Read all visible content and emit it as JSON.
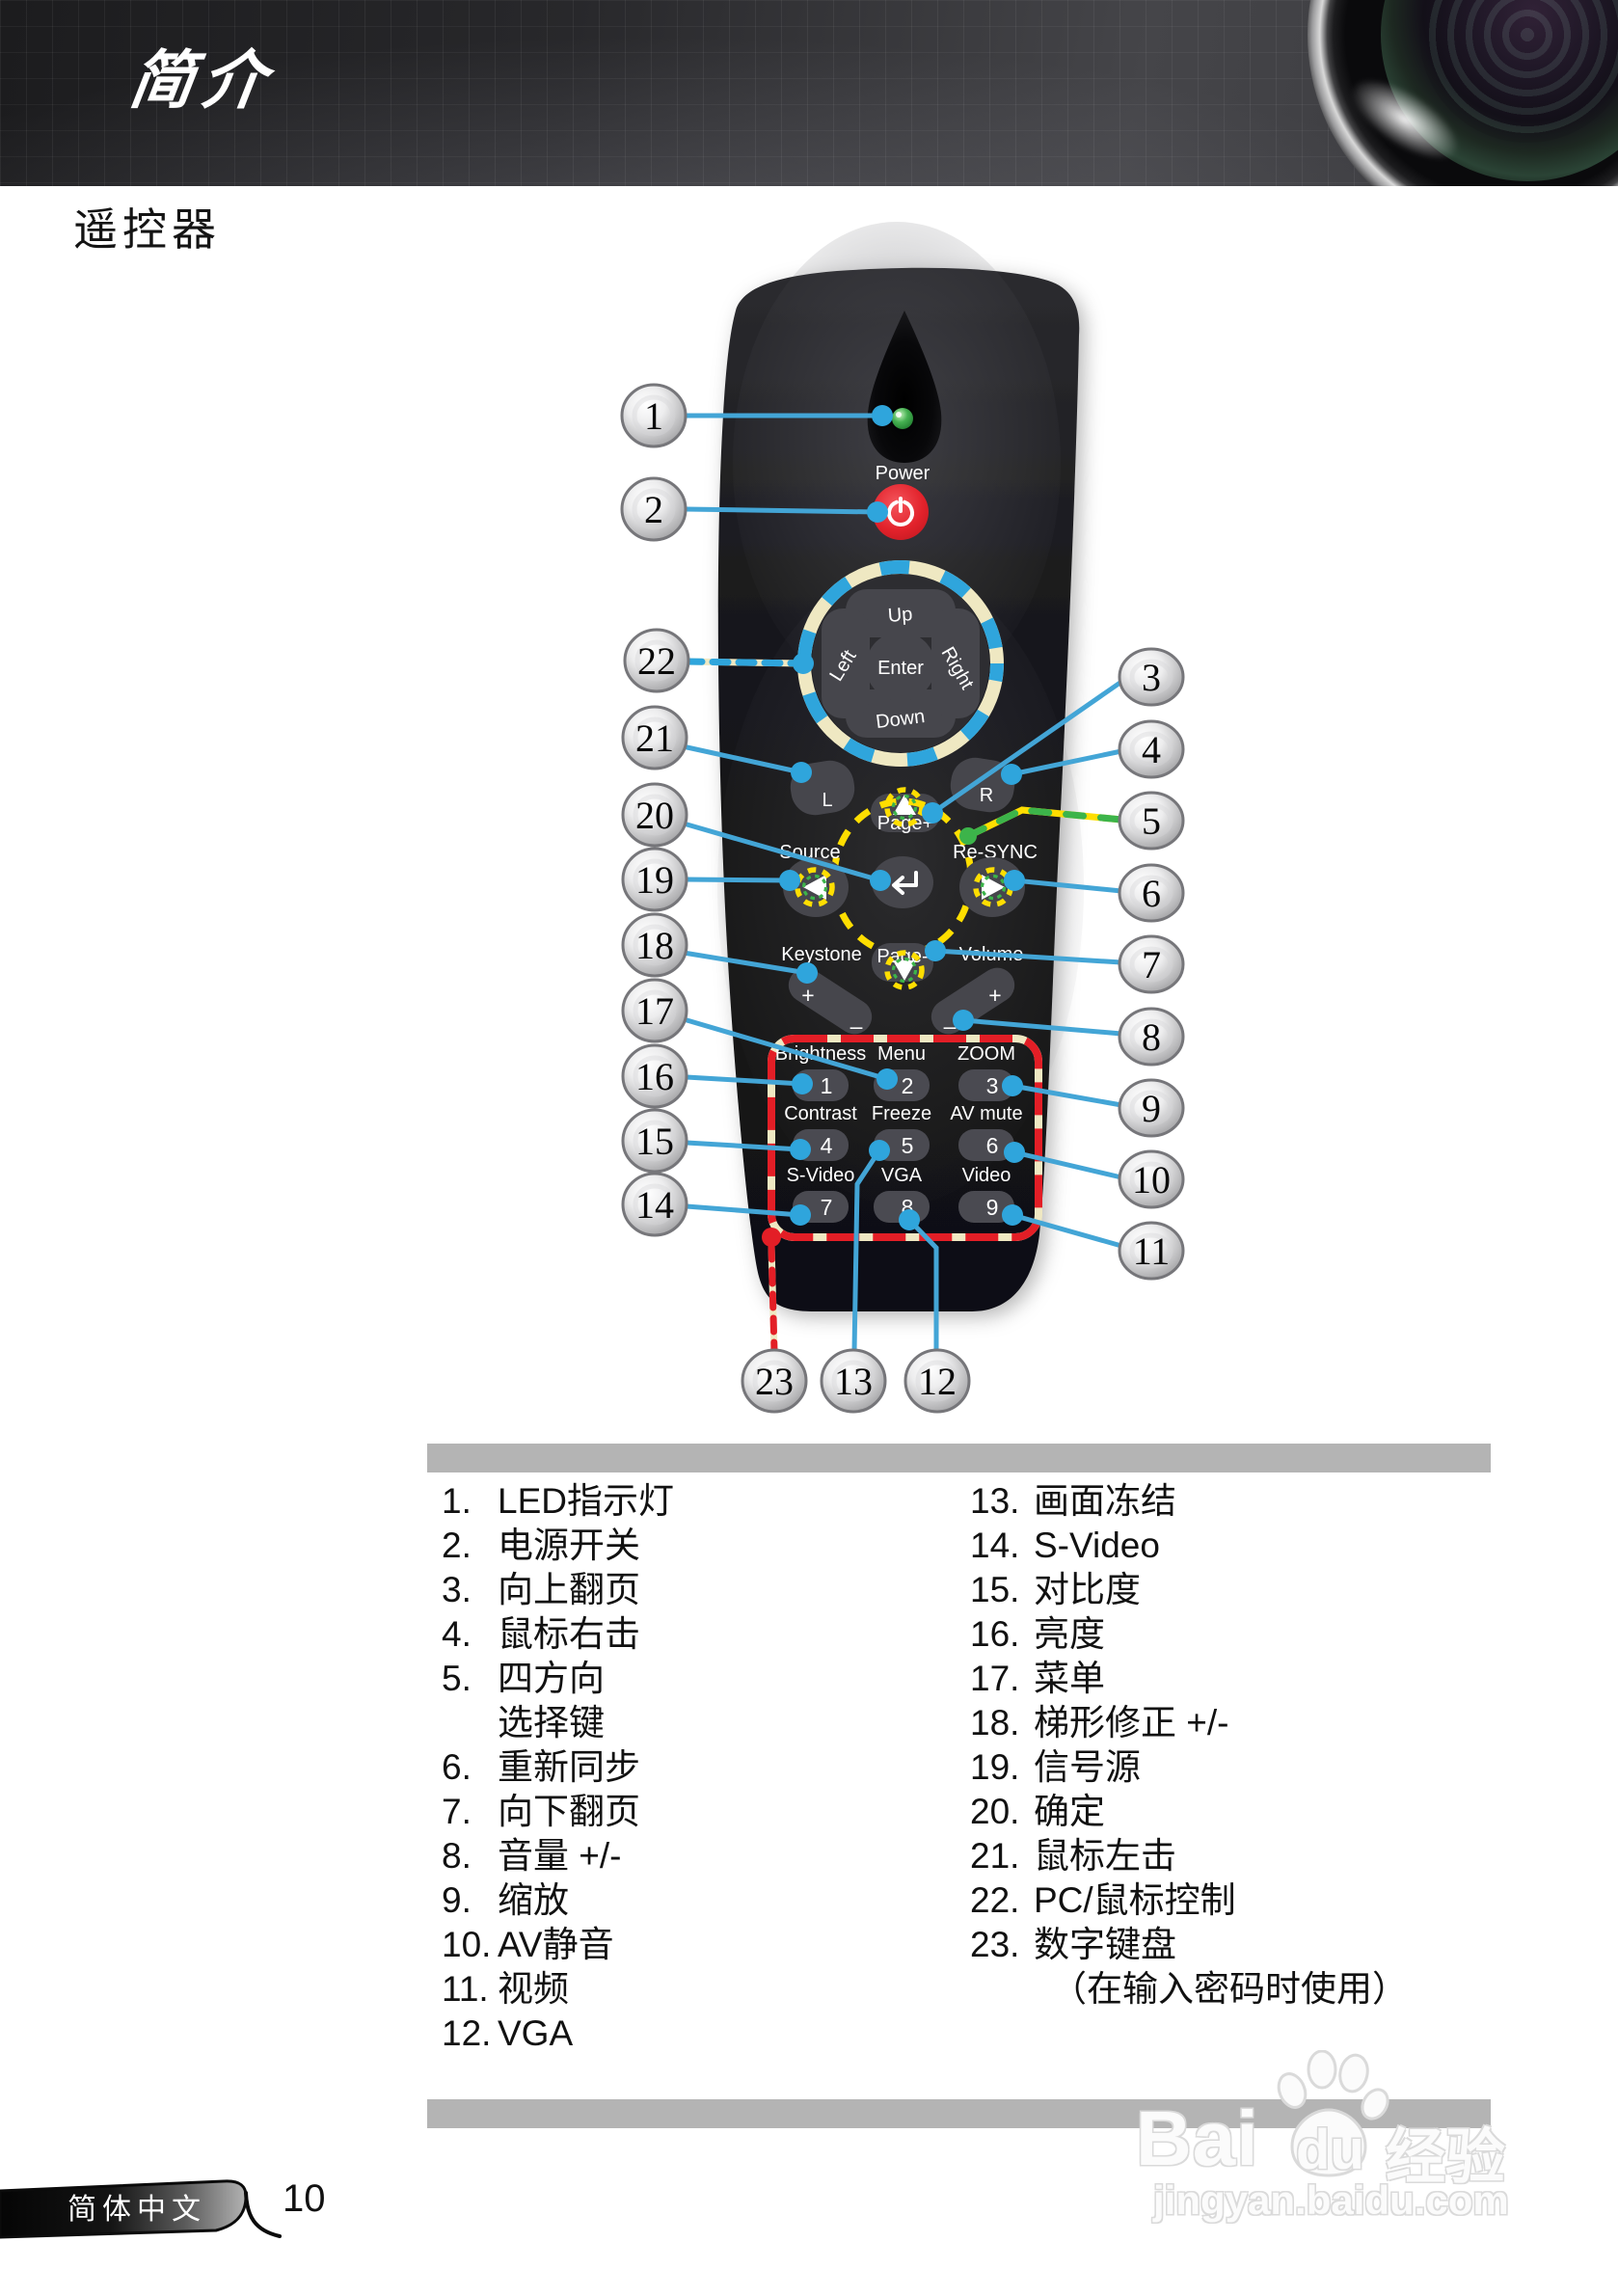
{
  "header": {
    "title": "简介"
  },
  "page": {
    "heading": "遥控器",
    "footer_tab": "简体中文",
    "page_number": "10"
  },
  "watermark": {
    "brand_prefix": "Bai",
    "brand_mid": "du",
    "brand_cjk": "经验",
    "url": "jingyan.baidu.com"
  },
  "remote": {
    "power_label": "Power",
    "nav": {
      "up": "Up",
      "down": "Down",
      "left": "Left",
      "right": "Right",
      "enter": "Enter"
    },
    "mouse_left": "L",
    "mouse_right": "R",
    "page_up": "Page+",
    "page_down": "Page-",
    "source": "Source",
    "resync": "Re-SYNC",
    "keystone": "Keystone",
    "volume": "Volume",
    "plus": "+",
    "minus": "–",
    "keypad": [
      {
        "label": "Brightness",
        "digit": "1"
      },
      {
        "label": "Menu",
        "digit": "2"
      },
      {
        "label": "ZOOM",
        "digit": "3"
      },
      {
        "label": "Contrast",
        "digit": "4"
      },
      {
        "label": "Freeze",
        "digit": "5"
      },
      {
        "label": "AV mute",
        "digit": "6"
      },
      {
        "label": "S-Video",
        "digit": "7"
      },
      {
        "label": "VGA",
        "digit": "8"
      },
      {
        "label": "Video",
        "digit": "9"
      }
    ]
  },
  "callouts": [
    "1",
    "2",
    "22",
    "21",
    "20",
    "19",
    "18",
    "17",
    "16",
    "15",
    "14",
    "3",
    "4",
    "5",
    "6",
    "7",
    "8",
    "9",
    "10",
    "11",
    "23",
    "13",
    "12"
  ],
  "legend": {
    "left": [
      {
        "n": "1.",
        "t": "LED指示灯"
      },
      {
        "n": "2.",
        "t": "电源开关"
      },
      {
        "n": "3.",
        "t": "向上翻页"
      },
      {
        "n": "4.",
        "t": "鼠标右击"
      },
      {
        "n": "5.",
        "t": "四方向"
      },
      {
        "n": "",
        "t": "选择键"
      },
      {
        "n": "6.",
        "t": "重新同步"
      },
      {
        "n": "7.",
        "t": "向下翻页"
      },
      {
        "n": "8.",
        "t": "音量 +/-"
      },
      {
        "n": "9.",
        "t": "缩放"
      },
      {
        "n": "10.",
        "t": "AV静音"
      },
      {
        "n": "11.",
        "t": "视频"
      },
      {
        "n": "12.",
        "t": "VGA"
      }
    ],
    "right": [
      {
        "n": "13.",
        "t": "画面冻结"
      },
      {
        "n": "14.",
        "t": "S-Video"
      },
      {
        "n": "15.",
        "t": "对比度"
      },
      {
        "n": "16.",
        "t": "亮度"
      },
      {
        "n": "17.",
        "t": "菜单"
      },
      {
        "n": "18.",
        "t": "梯形修正 +/-"
      },
      {
        "n": "19.",
        "t": "信号源"
      },
      {
        "n": "20.",
        "t": "确定"
      },
      {
        "n": "21.",
        "t": "鼠标左击"
      },
      {
        "n": "22.",
        "t": "PC/鼠标控制"
      },
      {
        "n": "23.",
        "t": "数字键盘"
      },
      {
        "n": "",
        "t": "（在输入密码时使用）"
      }
    ]
  },
  "colors": {
    "accent_blue": "#2FA5DC",
    "power_red": "#E8232E",
    "dash_yellow": "#FFDE00",
    "dash_green": "#3CB44A",
    "dash_red": "#E31E26",
    "dash_cream": "#EFE8C2",
    "bar_gray": "#B4B4B4"
  }
}
